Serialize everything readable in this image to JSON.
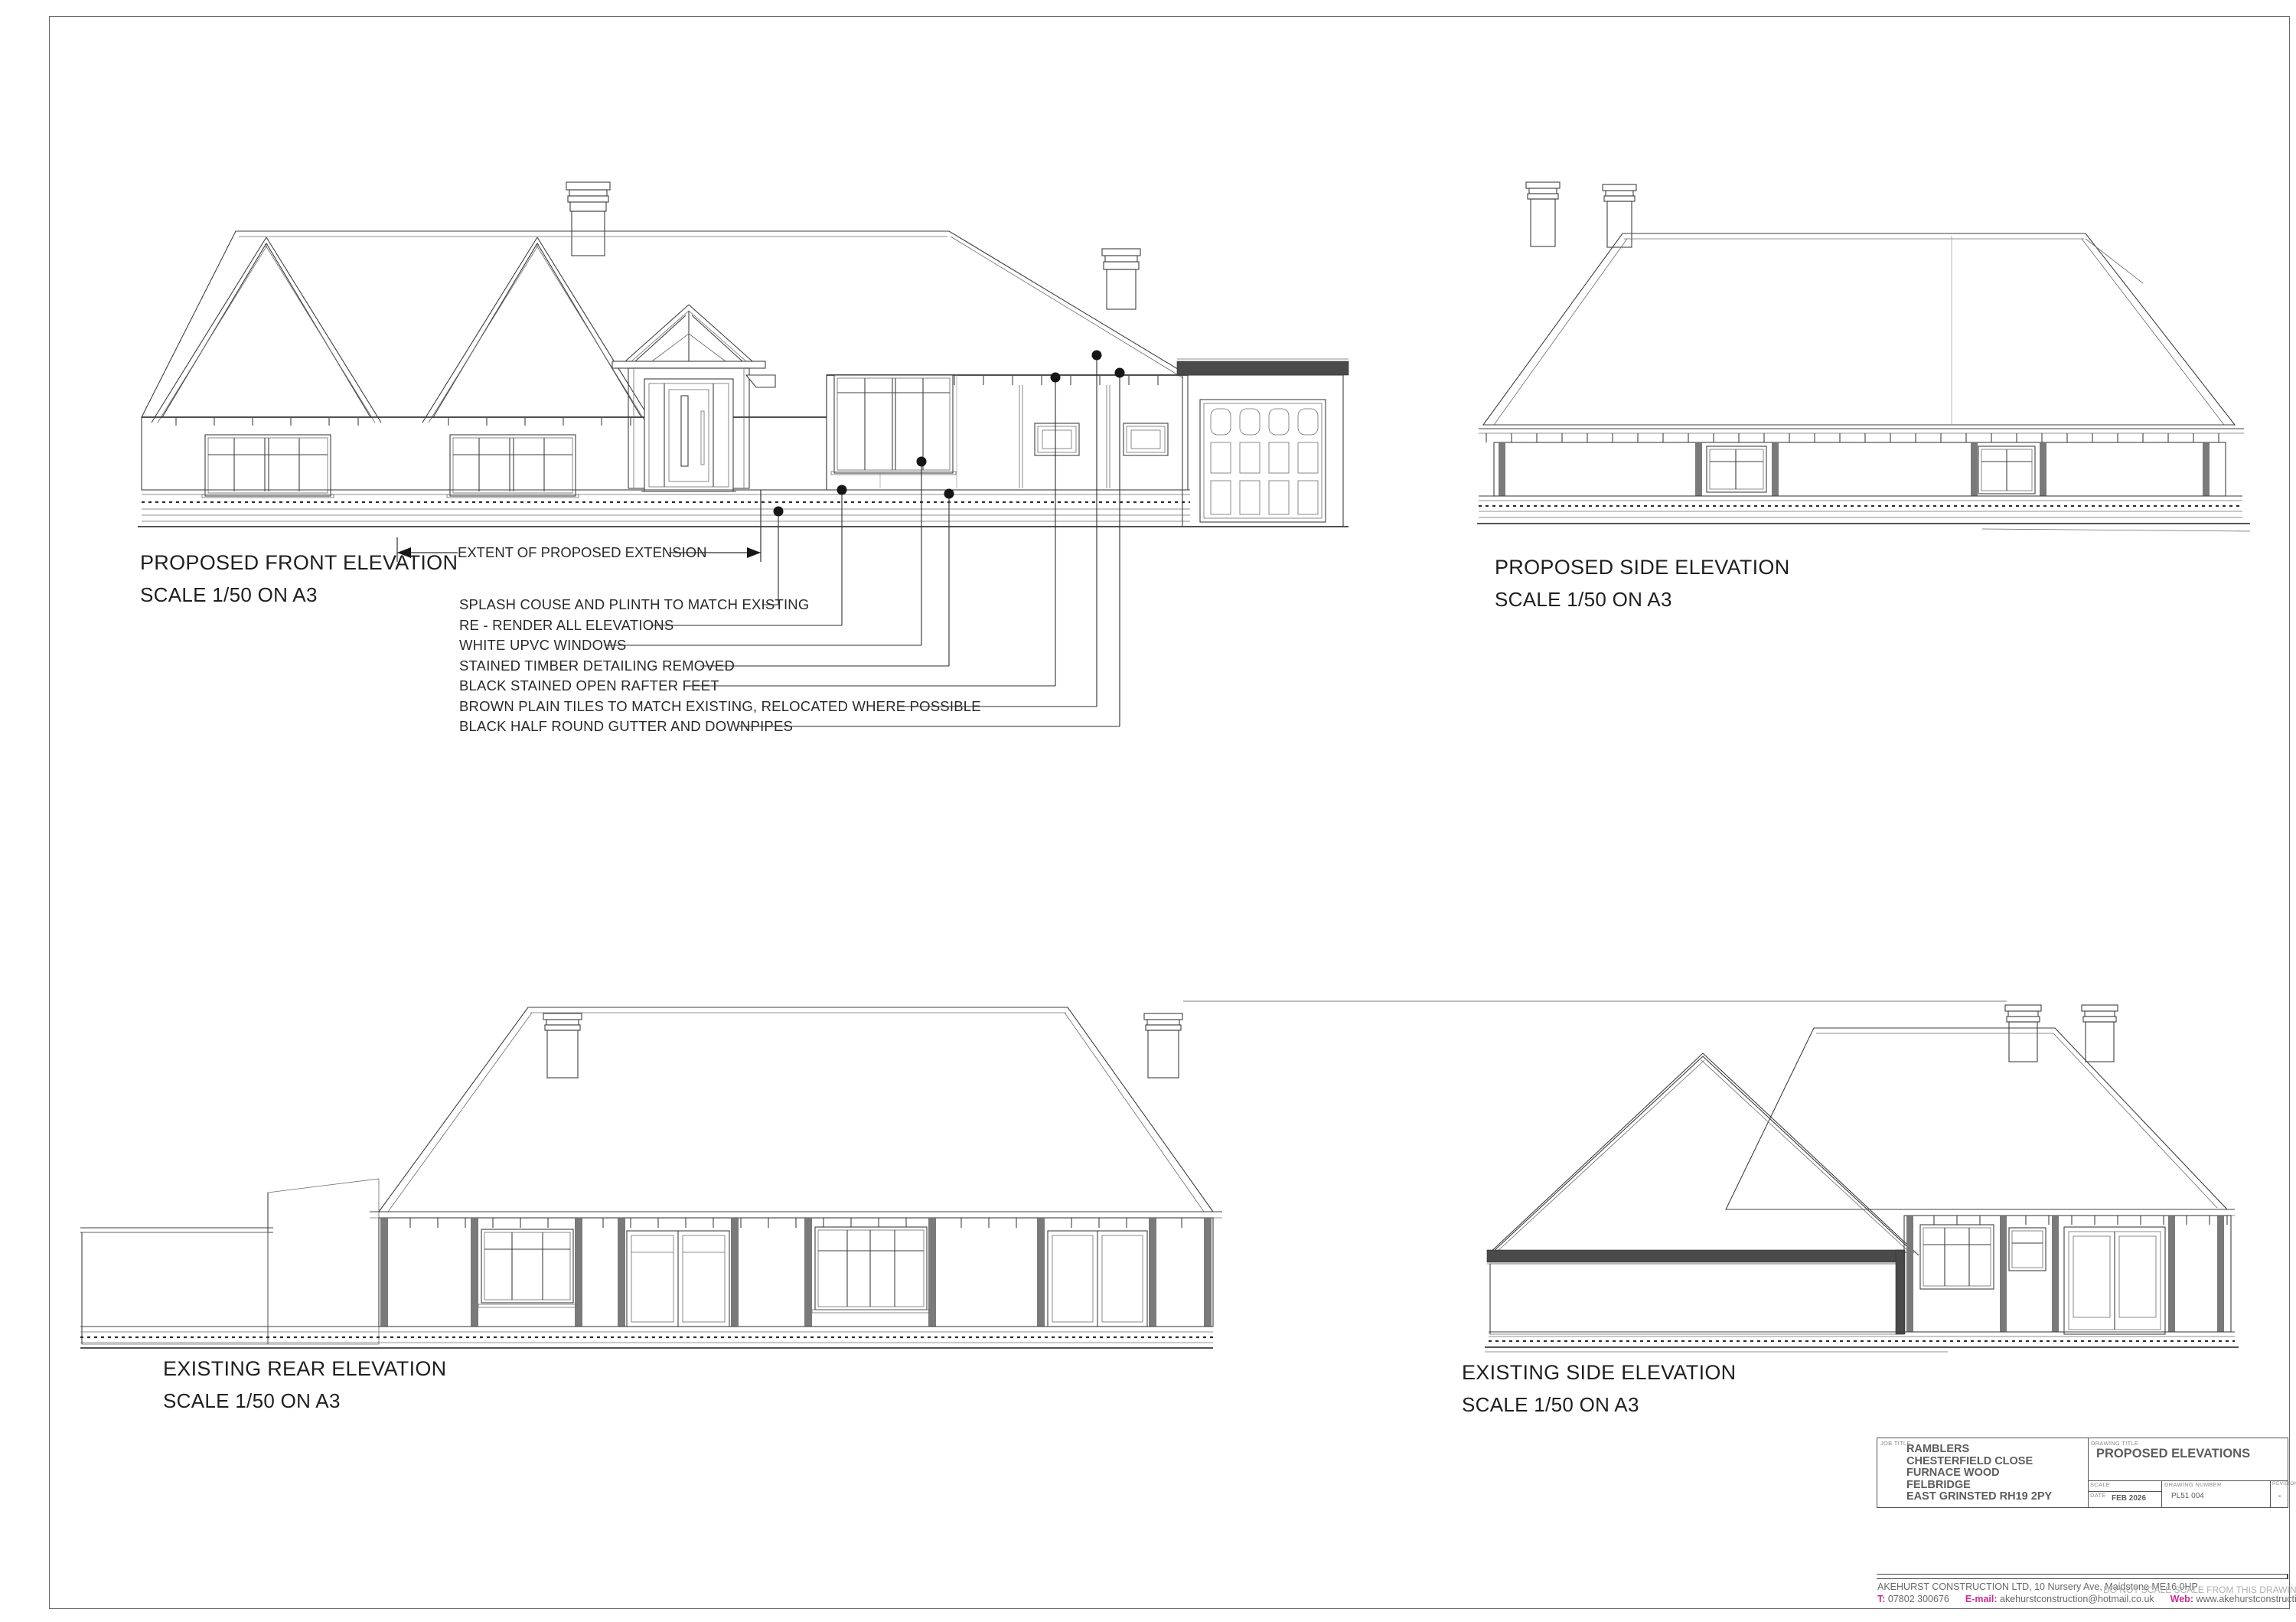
{
  "sheet": {
    "elevations": [
      {
        "title": "PROPOSED FRONT ELEVATION",
        "scale": "SCALE 1/50 ON A3"
      },
      {
        "title": "PROPOSED SIDE ELEVATION",
        "scale": "SCALE 1/50 ON A3"
      },
      {
        "title": "EXISTING REAR ELEVATION",
        "scale": "SCALE 1/50 ON A3"
      },
      {
        "title": "EXISTING SIDE ELEVATION",
        "scale": "SCALE 1/50 ON A3"
      }
    ],
    "extent_label": "EXTENT OF PROPOSED EXTENSION",
    "annotations": [
      "SPLASH COUSE AND PLINTH TO MATCH EXISTING",
      "RE - RENDER ALL ELEVATIONS",
      "WHITE UPVC WINDOWS",
      "STAINED TIMBER DETAILING REMOVED",
      "BLACK STAINED OPEN RAFTER FEET",
      "BROWN PLAIN TILES TO MATCH EXISTING, RELOCATED WHERE POSSIBLE",
      "BLACK HALF ROUND GUTTER AND DOWNPIPES"
    ],
    "title_block": {
      "job_title_label": "JOB TITLE",
      "job_title_lines": [
        "RAMBLERS",
        "CHESTERFIELD CLOSE",
        "FURNACE WOOD",
        "FELBRIDGE",
        "EAST GRINSTED RH19 2PY"
      ],
      "drawing_title_label": "DRAWING TITLE",
      "drawing_title": "PROPOSED ELEVATIONS",
      "scale_label": "SCALE",
      "scale_value": "",
      "date_label": "DATE",
      "date_value": "FEB 2026",
      "drawing_number_label": "DRAWING NUMBER",
      "drawing_number_value": "PL51 004",
      "revision_label": "REVISION",
      "revision_value": "-"
    },
    "footer": {
      "company_line": "AKEHURST CONSTRUCTION LTD, 10 Nursery Ave, Maidstone ME16 0HP",
      "tel_label": "T:",
      "tel_value": "07802 300676",
      "email_label": "E-mail:",
      "email_value": "akehurstconstruction@hotmail.co.uk",
      "web_label": "Web:",
      "web_value": "www.akehurstconstruction.co.uk",
      "disclaimer": "DO NOT SCALE SCALE FROM THIS DRAWING"
    },
    "colors": {
      "line": "#3f3f3f",
      "timber_post": "#7a7a7a",
      "fascia_dark": "#4a4a4a",
      "title_text": "#1f1f1f",
      "block_text": "#5d5d5d",
      "magenta": "#c72f92",
      "disclaimer_gray": "#b0b0b0"
    }
  }
}
